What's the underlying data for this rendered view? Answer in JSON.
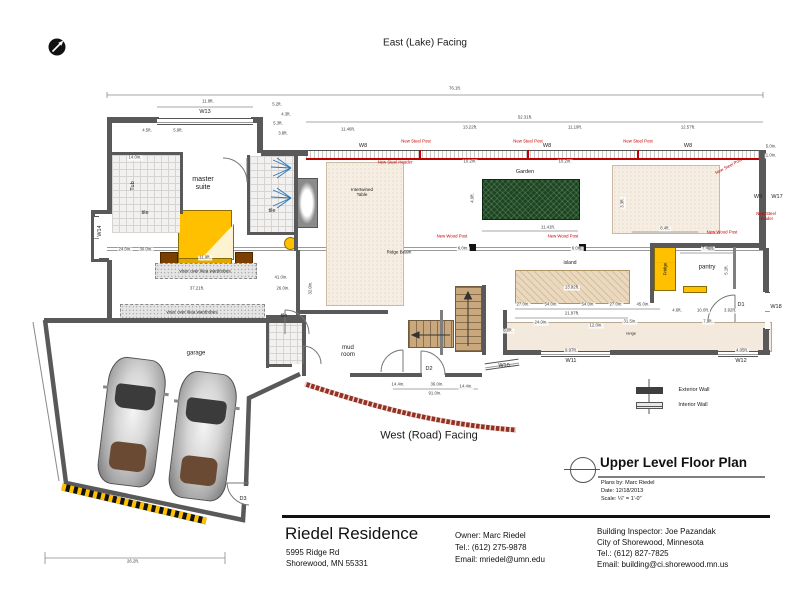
{
  "page": {
    "top_label": "East (Lake) Facing",
    "bottom_label": "West (Road) Facing"
  },
  "plan_title": {
    "title": "Upper Level Floor Plan",
    "plans_by": "Plans by: Marc Riedel",
    "date": "Date: 12/18/2013",
    "scale": "Scale: ¼\" = 1'-0\""
  },
  "legend": {
    "exterior": "Exterior Wall",
    "interior": "Interior Wall"
  },
  "title_block": {
    "name": "Riedel Residence",
    "address_line1": "5995 Ridge Rd",
    "address_line2": "Shorewood, MN  55331",
    "owner": [
      "Owner: Marc Riedel",
      "Tel.: (612) 275-9878",
      "Email: mriedel@umn.edu"
    ],
    "inspector": [
      "Building Inspector: Joe Pazandak",
      "City of Shorewood, Minnesota",
      "Tel.: (612) 827-7825",
      "Email: building@ci.shorewood.mn.us"
    ]
  },
  "colors": {
    "furniture_yellow": "#FFC000",
    "annotation_red": "#C00000",
    "garden_green": "#1C4620",
    "wall_gray": "#595959",
    "coffee_table_red": "#C00000"
  },
  "plan": {
    "walls": [
      [
        107,
        117,
        52,
        6
      ],
      [
        251,
        117,
        12,
        6
      ],
      [
        257,
        121,
        6,
        32
      ],
      [
        261,
        150,
        47,
        6
      ],
      [
        107,
        117,
        5,
        97
      ],
      [
        93,
        210,
        16,
        4
      ],
      [
        91,
        210,
        4,
        52
      ],
      [
        93,
        258,
        16,
        4
      ],
      [
        107,
        260,
        5,
        62
      ],
      [
        44,
        318,
        260,
        5
      ],
      [
        759,
        150,
        7,
        100
      ],
      [
        763,
        248,
        6,
        44
      ],
      [
        763,
        328,
        6,
        27
      ],
      [
        505,
        350,
        36,
        5
      ],
      [
        610,
        350,
        108,
        5
      ],
      [
        758,
        350,
        12,
        5
      ],
      [
        503,
        310,
        4,
        45
      ],
      [
        300,
        310,
        88,
        4
      ],
      [
        650,
        243,
        115,
        5
      ],
      [
        650,
        247,
        4,
        56
      ],
      [
        482,
        285,
        4,
        70
      ],
      [
        350,
        373,
        72,
        4
      ],
      [
        445,
        373,
        37,
        4
      ],
      [
        266,
        315,
        40,
        3
      ],
      [
        266,
        315,
        3,
        53
      ],
      [
        303,
        315,
        3,
        53
      ],
      [
        266,
        364,
        26,
        3
      ],
      [
        109,
        152,
        74,
        3
      ],
      [
        180,
        152,
        3,
        62
      ],
      [
        247,
        155,
        3,
        80
      ],
      [
        294,
        155,
        4,
        96
      ],
      [
        247,
        232,
        51,
        3
      ],
      [
        296,
        250,
        4,
        72
      ],
      [
        302,
        320,
        4,
        56
      ]
    ],
    "interior_walls": [
      [
        733,
        247,
        3,
        42
      ],
      [
        440,
        310,
        3,
        45
      ]
    ],
    "windows": [
      [
        157,
        118,
        96,
        5,
        0
      ],
      [
        94,
        216,
        5,
        42,
        0
      ],
      [
        765,
        292,
        5,
        36,
        0
      ],
      [
        541,
        351,
        69,
        4,
        0
      ],
      [
        718,
        351,
        40,
        4,
        0
      ],
      [
        485,
        361,
        34,
        5,
        -8
      ]
    ],
    "surfaces": [
      {
        "x": 326,
        "y": 162,
        "w": 76,
        "h": 142,
        "cl": "rug"
      },
      {
        "x": 612,
        "y": 165,
        "w": 106,
        "h": 67,
        "cl": "rug"
      },
      {
        "x": 515,
        "y": 270,
        "w": 113,
        "h": 32,
        "cl": "island"
      },
      {
        "x": 505,
        "y": 322,
        "w": 265,
        "h": 28,
        "cl": "counter"
      },
      {
        "x": 112,
        "y": 155,
        "w": 68,
        "h": 78,
        "cl": "tile"
      },
      {
        "x": 250,
        "y": 156,
        "w": 44,
        "h": 76,
        "cl": "tile"
      },
      {
        "x": 269,
        "y": 318,
        "w": 34,
        "h": 46,
        "cl": "tile"
      },
      {
        "x": 155,
        "y": 263,
        "w": 100,
        "h": 14,
        "cl": "ward"
      },
      {
        "x": 120,
        "y": 304,
        "w": 143,
        "h": 15,
        "cl": "ward"
      }
    ],
    "dimlines": [
      [
        107,
        95,
        763,
        95
      ],
      [
        107,
        92,
        107,
        98
      ],
      [
        763,
        92,
        763,
        98
      ],
      [
        157,
        107,
        253,
        107
      ],
      [
        306,
        122,
        763,
        122
      ],
      [
        482,
        231,
        578,
        231
      ],
      [
        632,
        232,
        698,
        232
      ],
      [
        680,
        253,
        736,
        253
      ],
      [
        515,
        309,
        660,
        309
      ],
      [
        515,
        318,
        628,
        318
      ],
      [
        393,
        389,
        478,
        389
      ],
      [
        45,
        558,
        225,
        558
      ],
      [
        45,
        552,
        45,
        564
      ],
      [
        225,
        552,
        225,
        564
      ]
    ],
    "labels": [
      {
        "k": "room",
        "t": "master\nsuite",
        "x": 203,
        "y": 184,
        "s": 7
      },
      {
        "k": "room",
        "t": "tile",
        "x": 145,
        "y": 213,
        "s": 5.5
      },
      {
        "k": "room",
        "t": "tile",
        "x": 272,
        "y": 211,
        "s": 5.5
      },
      {
        "k": "room",
        "t": "tile",
        "x": 284,
        "y": 317,
        "s": 5
      },
      {
        "k": "room",
        "t": "garage",
        "x": 196,
        "y": 354,
        "s": 6
      },
      {
        "k": "room",
        "t": "mud\nroom",
        "x": 348,
        "y": 352,
        "s": 6
      },
      {
        "k": "room",
        "t": "island",
        "x": 570,
        "y": 264,
        "s": 5
      },
      {
        "k": "room",
        "t": "pantry",
        "x": 707,
        "y": 268,
        "s": 6
      },
      {
        "k": "room",
        "t": "Garden",
        "x": 525,
        "y": 172,
        "s": 5.5
      },
      {
        "k": "room",
        "t": "Tub",
        "x": 133,
        "y": 186,
        "s": 5.5,
        "r": -90
      },
      {
        "k": "room",
        "t": "Fridge",
        "x": 665,
        "y": 269,
        "s": 4.5,
        "r": -90
      },
      {
        "k": "room",
        "t": "range",
        "x": 631,
        "y": 334,
        "s": 4
      },
      {
        "k": "room",
        "t": "Intertwined\nTable",
        "x": 362,
        "y": 192,
        "s": 4.5
      },
      {
        "k": "room",
        "t": "Ridge Beam",
        "x": 399,
        "y": 252,
        "s": 4.5
      },
      {
        "k": "room",
        "t": "visor over ikea wardrobes",
        "x": 205,
        "y": 271,
        "s": 4.5
      },
      {
        "k": "room",
        "t": "visor over ikea wardrobes",
        "x": 192,
        "y": 312,
        "s": 4.5
      },
      {
        "k": "tag",
        "t": "W13",
        "x": 205,
        "y": 112
      },
      {
        "k": "tag",
        "t": "W8",
        "x": 363,
        "y": 146
      },
      {
        "k": "tag",
        "t": "W8",
        "x": 547,
        "y": 146
      },
      {
        "k": "tag",
        "t": "W8",
        "x": 688,
        "y": 146
      },
      {
        "k": "tag",
        "t": "W9",
        "x": 758,
        "y": 197
      },
      {
        "k": "tag",
        "t": "W17",
        "x": 777,
        "y": 197
      },
      {
        "k": "tag",
        "t": "W14",
        "x": 100,
        "y": 231,
        "r": -90
      },
      {
        "k": "tag",
        "t": "W18",
        "x": 776,
        "y": 307
      },
      {
        "k": "tag",
        "t": "W10",
        "x": 504,
        "y": 366
      },
      {
        "k": "tag",
        "t": "W11",
        "x": 571,
        "y": 361
      },
      {
        "k": "tag",
        "t": "W12",
        "x": 741,
        "y": 361
      },
      {
        "k": "tag",
        "t": "D1",
        "x": 741,
        "y": 305
      },
      {
        "k": "tag",
        "t": "D2",
        "x": 429,
        "y": 369
      },
      {
        "k": "tag",
        "t": "D3",
        "x": 243,
        "y": 499
      },
      {
        "k": "red",
        "t": "New Steel Post",
        "x": 416,
        "y": 142
      },
      {
        "k": "red",
        "t": "New Steel Post",
        "x": 528,
        "y": 142
      },
      {
        "k": "red",
        "t": "New Steel Post",
        "x": 638,
        "y": 142
      },
      {
        "k": "red",
        "t": "New Steel Post",
        "x": 729,
        "y": 167,
        "r": -28
      },
      {
        "k": "red",
        "t": "New Steel Header",
        "x": 395,
        "y": 163
      },
      {
        "k": "red",
        "t": "New Steel Header",
        "x": 766,
        "y": 217
      },
      {
        "k": "red",
        "t": "New Wood Post",
        "x": 452,
        "y": 237
      },
      {
        "k": "red",
        "t": "New Wood Post",
        "x": 563,
        "y": 237
      },
      {
        "k": "red",
        "t": "New Wood Post",
        "x": 722,
        "y": 233
      },
      {
        "k": "dim",
        "t": "76.1ft.",
        "x": 455,
        "y": 89
      },
      {
        "k": "dim",
        "t": "11.8ft.",
        "x": 208,
        "y": 102
      },
      {
        "k": "dim",
        "t": "52.31ft.",
        "x": 525,
        "y": 118
      },
      {
        "k": "dim",
        "t": "13.22ft.",
        "x": 470,
        "y": 128
      },
      {
        "k": "dim",
        "t": "11.19ft.",
        "x": 575,
        "y": 128
      },
      {
        "k": "dim",
        "t": "12.57ft.",
        "x": 688,
        "y": 128
      },
      {
        "k": "dim",
        "t": "4.5ft.",
        "x": 147,
        "y": 131
      },
      {
        "k": "dim",
        "t": "5.9ft.",
        "x": 178,
        "y": 131
      },
      {
        "k": "dim",
        "t": "5.2ft.",
        "x": 277,
        "y": 105
      },
      {
        "k": "dim",
        "t": "4.3ft.",
        "x": 286,
        "y": 115
      },
      {
        "k": "dim",
        "t": "5.3ft.",
        "x": 278,
        "y": 124
      },
      {
        "k": "dim",
        "t": "3.8ft.",
        "x": 283,
        "y": 134
      },
      {
        "k": "dim",
        "t": "11.46ft.",
        "x": 348,
        "y": 130
      },
      {
        "k": "dim",
        "t": "14.0in.",
        "x": 135,
        "y": 158
      },
      {
        "k": "dim",
        "t": "11.9ft.",
        "x": 205,
        "y": 258
      },
      {
        "k": "dim",
        "t": "24.0in.",
        "x": 125,
        "y": 250
      },
      {
        "k": "dim",
        "t": "30.0in.",
        "x": 146,
        "y": 250
      },
      {
        "k": "dim",
        "t": "37.21ft.",
        "x": 197,
        "y": 289
      },
      {
        "k": "dim",
        "t": "41.0in.",
        "x": 281,
        "y": 278
      },
      {
        "k": "dim",
        "t": "26.0in.",
        "x": 283,
        "y": 289
      },
      {
        "k": "dim",
        "t": "32.0in.",
        "x": 311,
        "y": 288,
        "r": -90
      },
      {
        "k": "dim",
        "t": "10.2in.",
        "x": 470,
        "y": 162
      },
      {
        "k": "dim",
        "t": "10.2in.",
        "x": 565,
        "y": 162
      },
      {
        "k": "dim",
        "t": "4.9ft.",
        "x": 473,
        "y": 198,
        "r": -90
      },
      {
        "k": "dim",
        "t": "11.41ft.",
        "x": 548,
        "y": 228
      },
      {
        "k": "dim",
        "t": "6.0in.",
        "x": 463,
        "y": 249
      },
      {
        "k": "dim",
        "t": "6.0in.",
        "x": 577,
        "y": 249
      },
      {
        "k": "dim",
        "t": "8.4ft.",
        "x": 665,
        "y": 229
      },
      {
        "k": "dim",
        "t": "3.3ft.",
        "x": 623,
        "y": 203,
        "r": -90
      },
      {
        "k": "dim",
        "t": "7.46ft.",
        "x": 708,
        "y": 249
      },
      {
        "k": "dim",
        "t": "5.1ft.",
        "x": 727,
        "y": 270,
        "r": -90
      },
      {
        "k": "dim",
        "t": "4.6ft.",
        "x": 677,
        "y": 311
      },
      {
        "k": "dim",
        "t": "10.0ft.",
        "x": 703,
        "y": 311
      },
      {
        "k": "dim",
        "t": "3.92ft.",
        "x": 730,
        "y": 311
      },
      {
        "k": "dim",
        "t": "7.9ft.",
        "x": 708,
        "y": 322
      },
      {
        "k": "dim",
        "t": "13.92ft.",
        "x": 572,
        "y": 288
      },
      {
        "k": "dim",
        "t": "27.0in.",
        "x": 523,
        "y": 305
      },
      {
        "k": "dim",
        "t": "54.0in.",
        "x": 551,
        "y": 305
      },
      {
        "k": "dim",
        "t": "54.0in.",
        "x": 588,
        "y": 305
      },
      {
        "k": "dim",
        "t": "27.0in.",
        "x": 616,
        "y": 305
      },
      {
        "k": "dim",
        "t": "45.0in.",
        "x": 643,
        "y": 305
      },
      {
        "k": "dim",
        "t": "21.97ft.",
        "x": 572,
        "y": 314
      },
      {
        "k": "dim",
        "t": "24.0in.",
        "x": 541,
        "y": 323
      },
      {
        "k": "dim",
        "t": "12.0in.",
        "x": 596,
        "y": 326
      },
      {
        "k": "dim",
        "t": "31.5in.",
        "x": 630,
        "y": 322
      },
      {
        "k": "dim",
        "t": "6.0ft.",
        "x": 508,
        "y": 331
      },
      {
        "k": "dim",
        "t": "9.97ft.",
        "x": 571,
        "y": 351
      },
      {
        "k": "dim",
        "t": "4.05ft.",
        "x": 742,
        "y": 351
      },
      {
        "k": "dim",
        "t": "14.4in.",
        "x": 398,
        "y": 385
      },
      {
        "k": "dim",
        "t": "36.0in.",
        "x": 437,
        "y": 385
      },
      {
        "k": "dim",
        "t": "14.4in.",
        "x": 466,
        "y": 387
      },
      {
        "k": "dim",
        "t": "91.0in.",
        "x": 435,
        "y": 394
      },
      {
        "k": "dim",
        "t": "26.2ft.",
        "x": 133,
        "y": 562
      },
      {
        "k": "dim",
        "t": "5.0in.",
        "x": 771,
        "y": 147
      },
      {
        "k": "dim",
        "t": "1.0in.",
        "x": 771,
        "y": 156
      }
    ]
  }
}
